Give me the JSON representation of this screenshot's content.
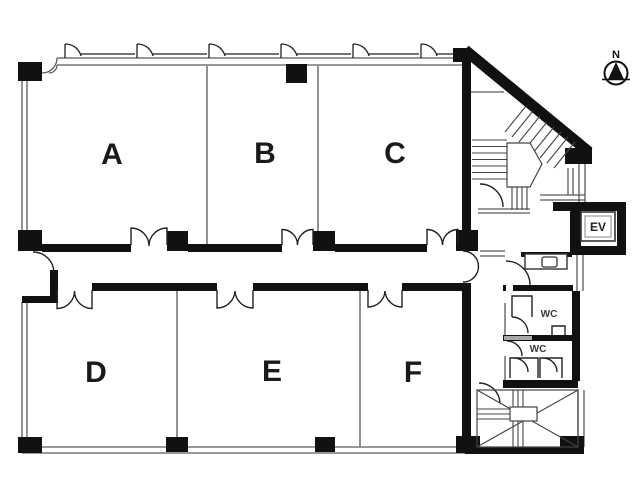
{
  "colors": {
    "background": "#ffffff",
    "walls": "#111111",
    "thin_lines": "#5a5a5a",
    "labels": "#1a1a1a"
  },
  "rooms": [
    {
      "label": "A"
    },
    {
      "label": "B"
    },
    {
      "label": "C"
    },
    {
      "label": "D"
    },
    {
      "label": "E"
    },
    {
      "label": "F"
    }
  ],
  "elevator": {
    "label": "EV"
  },
  "wc": {
    "upper": {
      "label": "WC"
    },
    "lower": {
      "label": "WC"
    }
  },
  "compass": {
    "label": "N"
  }
}
